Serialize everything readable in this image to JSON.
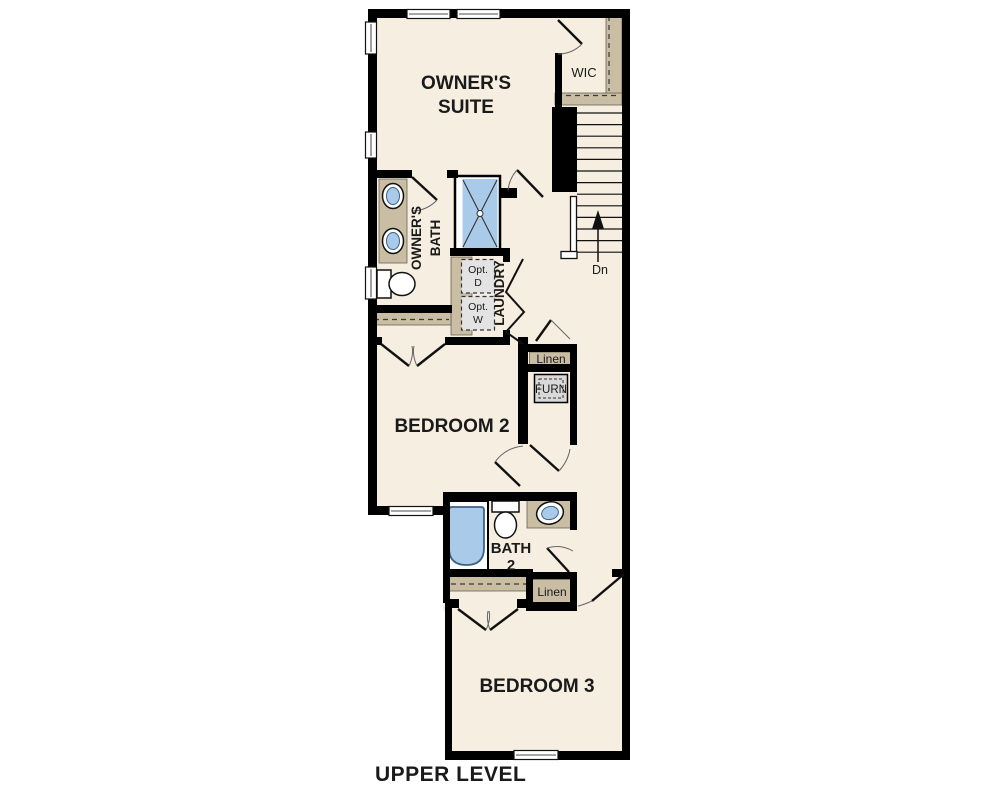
{
  "title": "UPPER LEVEL",
  "colors": {
    "floor": "#f6eee1",
    "wall": "#000000",
    "shelf": "#c9bda4",
    "shelf_border": "#6b6253",
    "fixture_blue": "#a9cbe9",
    "fixture_blue_dark": "#3d6285",
    "appliance_gray": "#e3e3e3",
    "furnace_gray": "#d9d9d9",
    "text": "#1a1a1a"
  },
  "rooms": {
    "owners_suite": {
      "line1": "OWNER'S",
      "line2": "SUITE"
    },
    "wic": {
      "label": "WIC"
    },
    "owners_bath": {
      "line1": "OWNER'S",
      "line2": "BATH"
    },
    "laundry": {
      "label": "LAUNDRY",
      "opt_dryer": {
        "line1": "Opt.",
        "line2": "D"
      },
      "opt_washer": {
        "line1": "Opt.",
        "line2": "W"
      }
    },
    "stairs": {
      "label": "Dn"
    },
    "bedroom2": {
      "label": "BEDROOM 2"
    },
    "linen_upper": {
      "label": "Linen"
    },
    "furnace": {
      "label": "FURN"
    },
    "bath2": {
      "line1": "BATH",
      "line2": "2"
    },
    "linen_lower": {
      "label": "Linen"
    },
    "bedroom3": {
      "label": "BEDROOM 3"
    }
  }
}
